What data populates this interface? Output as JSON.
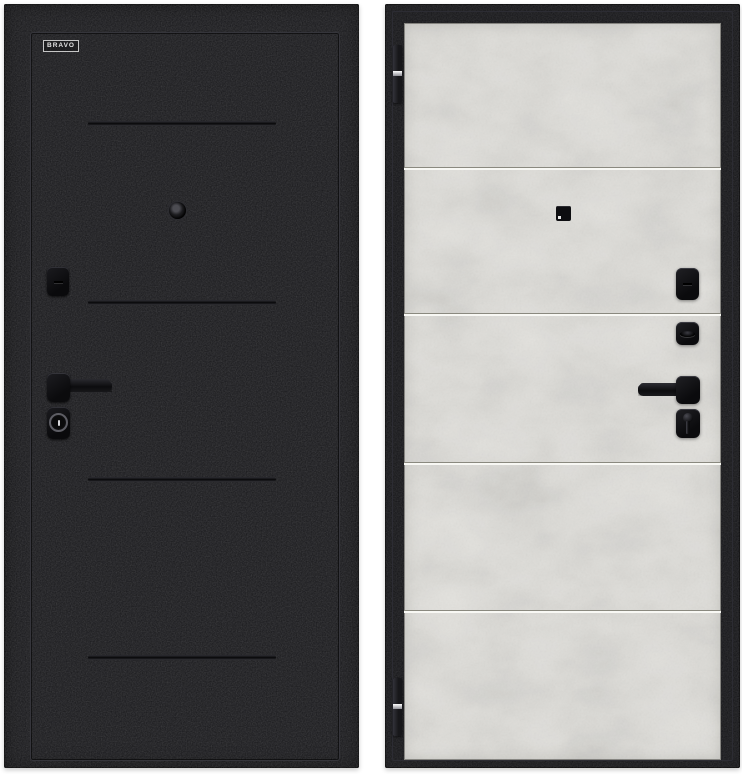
{
  "page": {
    "background": "#ffffff",
    "subject": "steel entrance door shown from both sides"
  },
  "left_door": {
    "side": "exterior-side-black",
    "finish_color": "#17171a",
    "brand": {
      "label": "BRAVO"
    },
    "grooves": {
      "count": 4
    },
    "hardware": {
      "peephole": "round peephole",
      "lock_cover": "deadbolt cover with slot",
      "handle": "lever handle pointing right",
      "cylinder": "key cylinder with round escutcheon"
    }
  },
  "right_door": {
    "side": "interior-side-light-panel",
    "frame_color": "#141417",
    "panel_color": "#e6e5e1",
    "panel_dividers": {
      "count": 4
    },
    "hinges": {
      "count": 2
    },
    "hardware": {
      "peephole": "square peephole cover",
      "deadbolt_cover": "cover with slot",
      "thumbturn": "oval thumbturn knob",
      "handle": "lever handle pointing left",
      "cylinder": "key cylinder escutcheon"
    }
  }
}
